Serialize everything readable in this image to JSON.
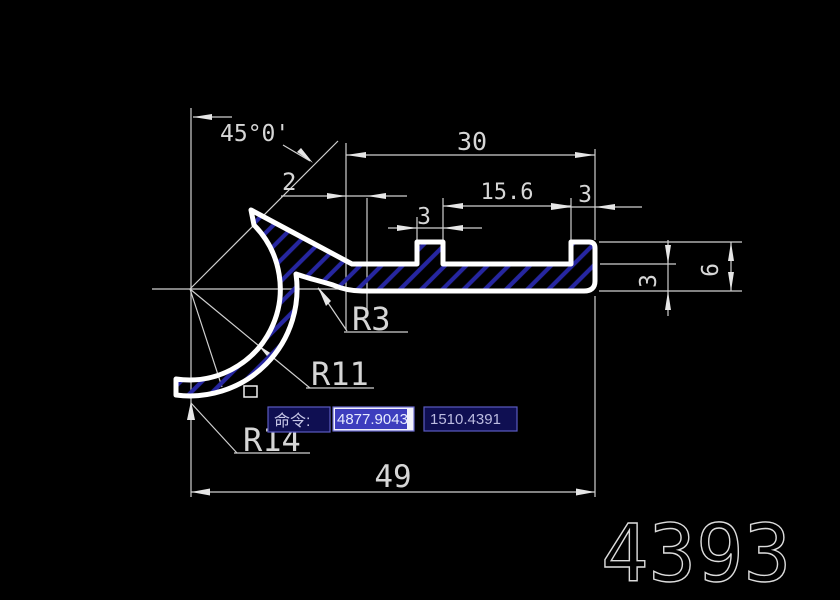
{
  "window": {
    "background": "#000000"
  },
  "drawing": {
    "part_number": "4393",
    "labels": {
      "angle": "45°0'",
      "arm_thickness": "2",
      "top_length": "30",
      "groove_span": "15.6",
      "tooth_left_width": "3",
      "tooth_right_width": "3",
      "plate_thickness": "3",
      "end_height": "6",
      "overall_length": "49",
      "fillet_radius": "R3",
      "inner_radius": "R11",
      "outer_radius": "R14"
    },
    "colors": {
      "outline": "#ffffff",
      "hatch": "#2626a0",
      "dimension": "#d4d4d4"
    }
  },
  "command_bar": {
    "prompt": "命令:",
    "coord_x": "4877.9043",
    "coord_y": "1510.4391"
  }
}
